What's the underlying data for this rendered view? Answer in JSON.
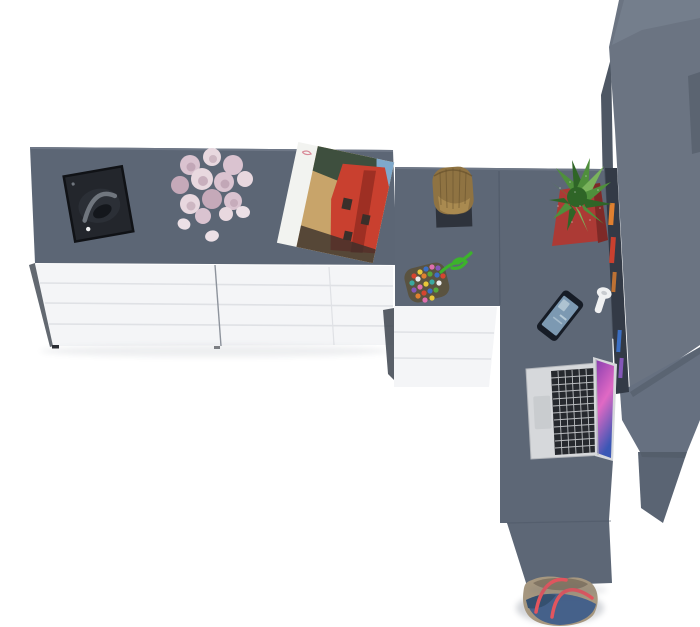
{
  "scene": {
    "title": "Top-down 3D render of an L-shaped desk and sideboard arrangement",
    "view": "top-down product render, white floor background",
    "objects": [
      {
        "id": "left-sideboard",
        "label": "long sideboard with grey top and white drawer fronts (two drawer columns)"
      },
      {
        "id": "headphones-tray",
        "label": "black tray holding grey headphones"
      },
      {
        "id": "rose-bouquet",
        "label": "bouquet of pale pink roses with three loose petals"
      },
      {
        "id": "magazine-poster",
        "label": "open magazine showing photo of a red building among trees"
      },
      {
        "id": "corner-desk",
        "label": "grey corner desk return running toward viewer"
      },
      {
        "id": "underdesk-drawers",
        "label": "white drawer unit under the desk"
      },
      {
        "id": "wooden-log-planter",
        "label": "wooden log vessel on a dark trivet"
      },
      {
        "id": "bead-charm",
        "label": "multicolour bead charm with bright green cord"
      },
      {
        "id": "cactus-red-pot",
        "label": "green succulent in a square red pot"
      },
      {
        "id": "smartphone",
        "label": "smartphone with blue lock screen, lying at an angle"
      },
      {
        "id": "white-hook",
        "label": "small white hook / earphone on the shelf edge"
      },
      {
        "id": "macbook-laptop",
        "label": "open silver laptop with purple wallpaper screen"
      },
      {
        "id": "tall-cabinet",
        "label": "tall grey cabinet / stepped shelf unit along right edge"
      },
      {
        "id": "shelf-books",
        "label": "colourful book spines in the dark shelf band"
      },
      {
        "id": "tote-bag",
        "label": "denim and khaki tote bag with red straps at the desk end"
      }
    ]
  },
  "colors": {
    "floor": "#ffffff",
    "counter_top": "#5c6675",
    "counter_edge": "#6e7786",
    "desk_top": "#5d6776",
    "desk_seam": "#4c5665",
    "drawer_white": "#f4f5f7",
    "drawer_seam": "#dfe1e5",
    "drawer_divider": "#8d939c",
    "side_dark": "#3c434e",
    "foot": "#2a2d33",
    "slab_main": "#6b7482",
    "slab_side": "#4e5764",
    "step_top": "#747e8c",
    "step_mid": "#667080",
    "step_low": "#5a6473",
    "hutch": "#333a46",
    "tray": "#23262c",
    "tray_edge": "#101216",
    "headphone": "#70767e",
    "headphone_dark": "#14171c",
    "headphone_cup": "#2b2f36",
    "rose_light": "#e8d8df",
    "rose_mid": "#dac3d0",
    "rose_deep": "#c5a9b9",
    "rose_core": "#b295a6",
    "petal": "#ece0e6",
    "poster_paper": "#f2f3f0",
    "poster_script": "#d98a98",
    "photo_sky": "#7fa9cc",
    "photo_tree": "#3e4f3e",
    "photo_red": "#c9402f",
    "photo_red_dark": "#9e2f23",
    "photo_warm": "#c8a46a",
    "photo_dark": "#3a2f2a",
    "log": "#8f7342",
    "log_dark": "#68522e",
    "log_light": "#b29256",
    "trivet": "#2e333c",
    "pot": "#ac3a35",
    "pot_dark": "#7e2a27",
    "cactus": "#4f8f3c",
    "cactus_dark": "#2f6527",
    "cactus_light": "#7ab35c",
    "cord": "#3cb32b",
    "bead_base": "#5a5340",
    "bead_red": "#d6452f",
    "bead_yellow": "#e8c83a",
    "bead_blue": "#3b6fc4",
    "bead_pink": "#df6fae",
    "bead_purple": "#8457b8",
    "bead_orange": "#e08030",
    "bead_teal": "#3aa9a0",
    "bead_white": "#ececec",
    "bead_green": "#56a83a",
    "phone_body": "#161c26",
    "phone_screen": "#7c99b2",
    "phone_glow": "#c3d4de",
    "hook": "#f0f1f2",
    "hook_edge": "#c9ccd0",
    "laptop_body": "#d6d8db",
    "laptop_edge": "#b4b7bc",
    "keys": "#26292e",
    "trackpad": "#c9cccf",
    "screen_a": "#8a3fb0",
    "screen_b": "#e069c4",
    "screen_c": "#3a57b5",
    "bag_tan": "#a6977f",
    "bag_tan_dark": "#837663",
    "bag_denim": "#45618a",
    "bag_denim_dark": "#35506f",
    "bag_strap": "#e2555e",
    "shadow": "#5a6473"
  }
}
